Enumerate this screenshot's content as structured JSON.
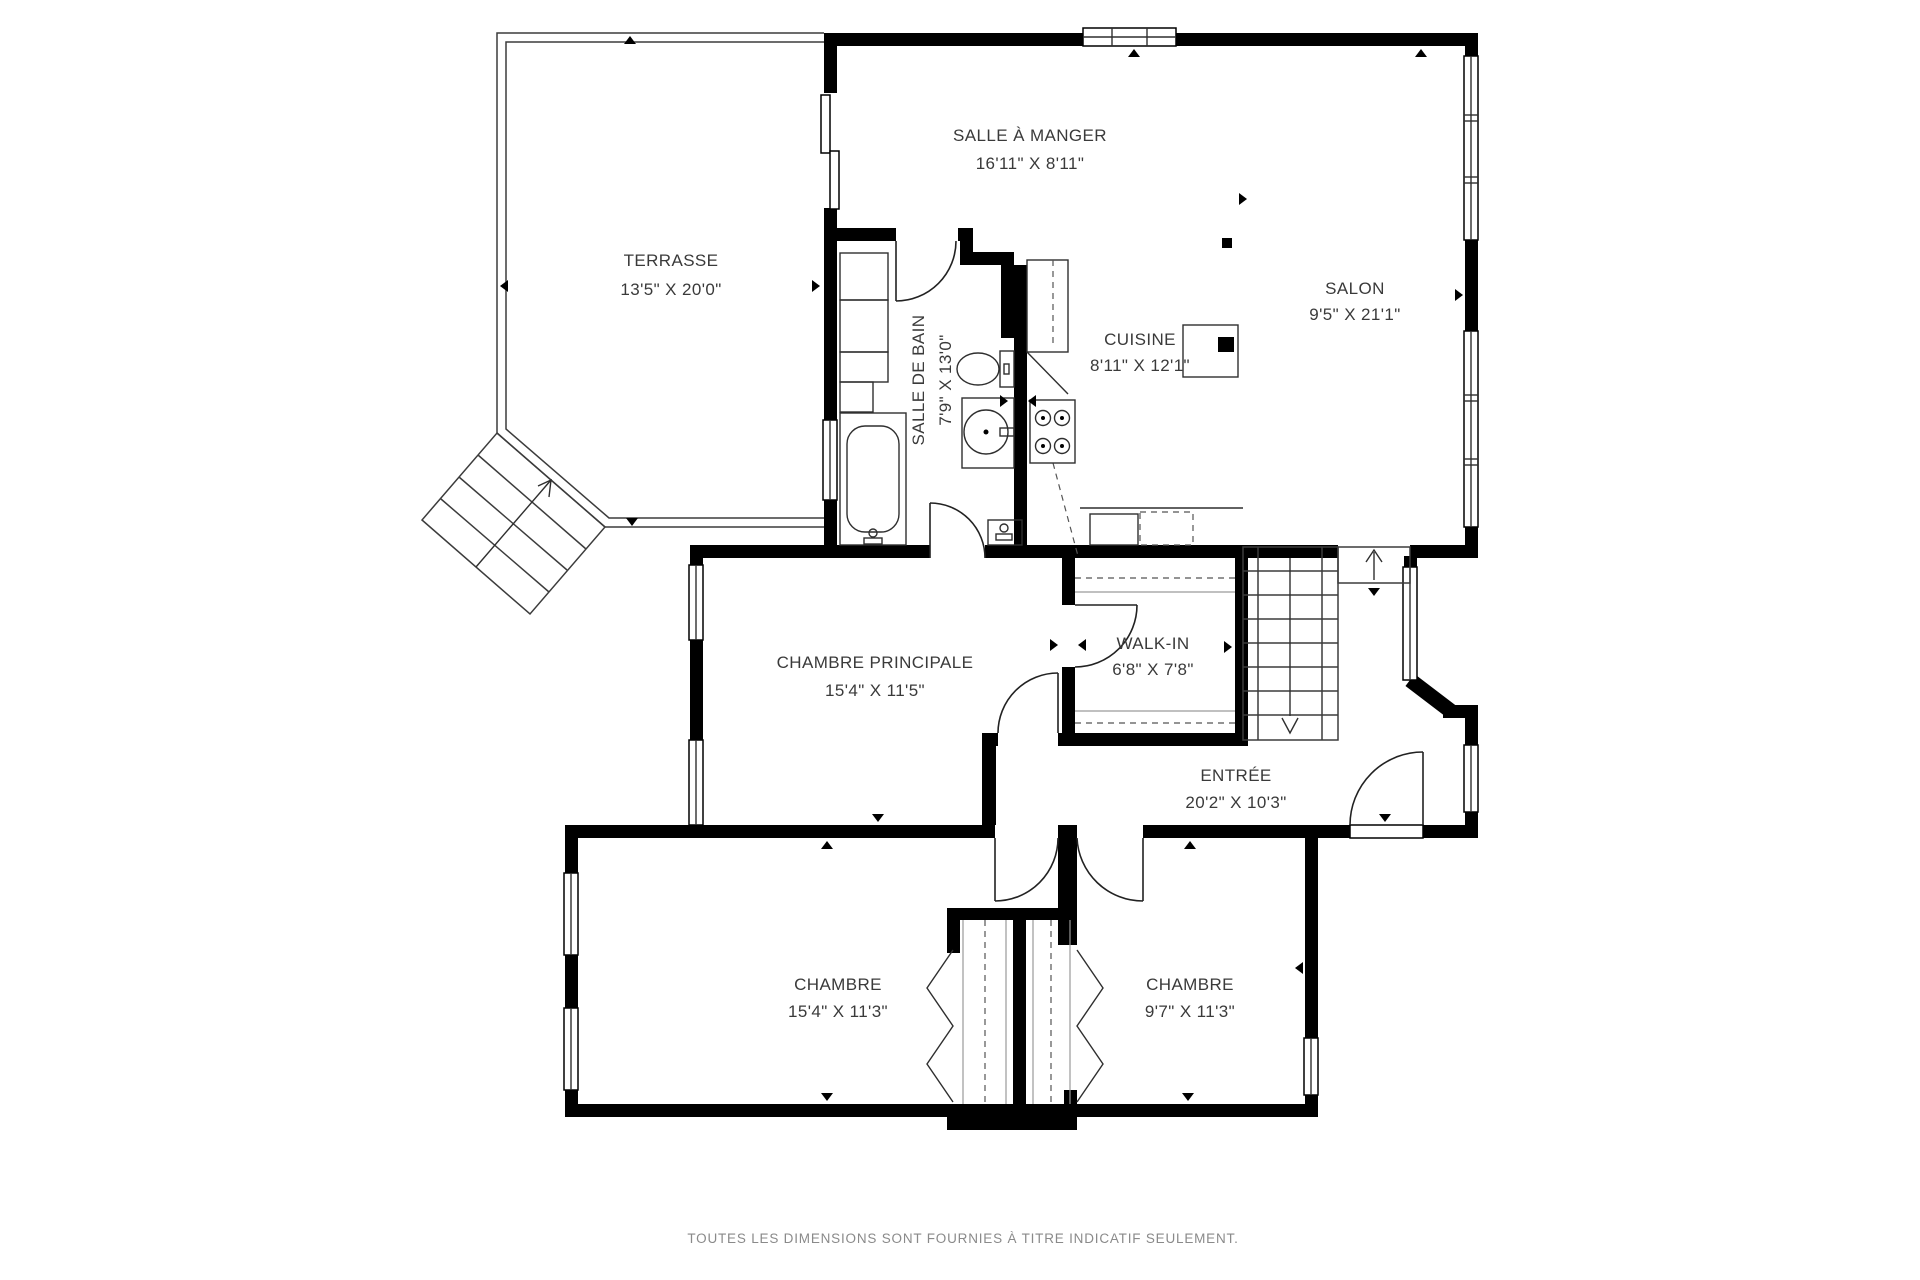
{
  "plan": {
    "rooms": {
      "terrasse": {
        "name": "TERRASSE",
        "dims": "13'5\" X 20'0\""
      },
      "salle_a_manger": {
        "name": "SALLE À MANGER",
        "dims": "16'11\" X 8'11\""
      },
      "salon": {
        "name": "SALON",
        "dims": "9'5\" X 21'1\""
      },
      "cuisine": {
        "name": "CUISINE",
        "dims": "8'11\" X 12'1\""
      },
      "salle_de_bain": {
        "name": "SALLE DE BAIN",
        "dims": "7'9\" X 13'0\""
      },
      "chambre_principale": {
        "name": "CHAMBRE PRINCIPALE",
        "dims": "15'4\" X 11'5\""
      },
      "walk_in": {
        "name": "WALK-IN",
        "dims": "6'8\" X 7'8\""
      },
      "entree": {
        "name": "ENTRÉE",
        "dims": "20'2\" X 10'3\""
      },
      "chambre_gauche": {
        "name": "CHAMBRE",
        "dims": "15'4\" X 11'3\""
      },
      "chambre_droite": {
        "name": "CHAMBRE",
        "dims": "9'7\" X 11'3\""
      }
    },
    "footer": {
      "disclaimer": "TOUTES LES DIMENSIONS SONT FOURNIES À TITRE INDICATIF SEULEMENT."
    },
    "colors": {
      "wall": "#000000",
      "line": "#3c3c3c",
      "label": "#3a3a3a",
      "muted": "#8a8a8a"
    }
  }
}
